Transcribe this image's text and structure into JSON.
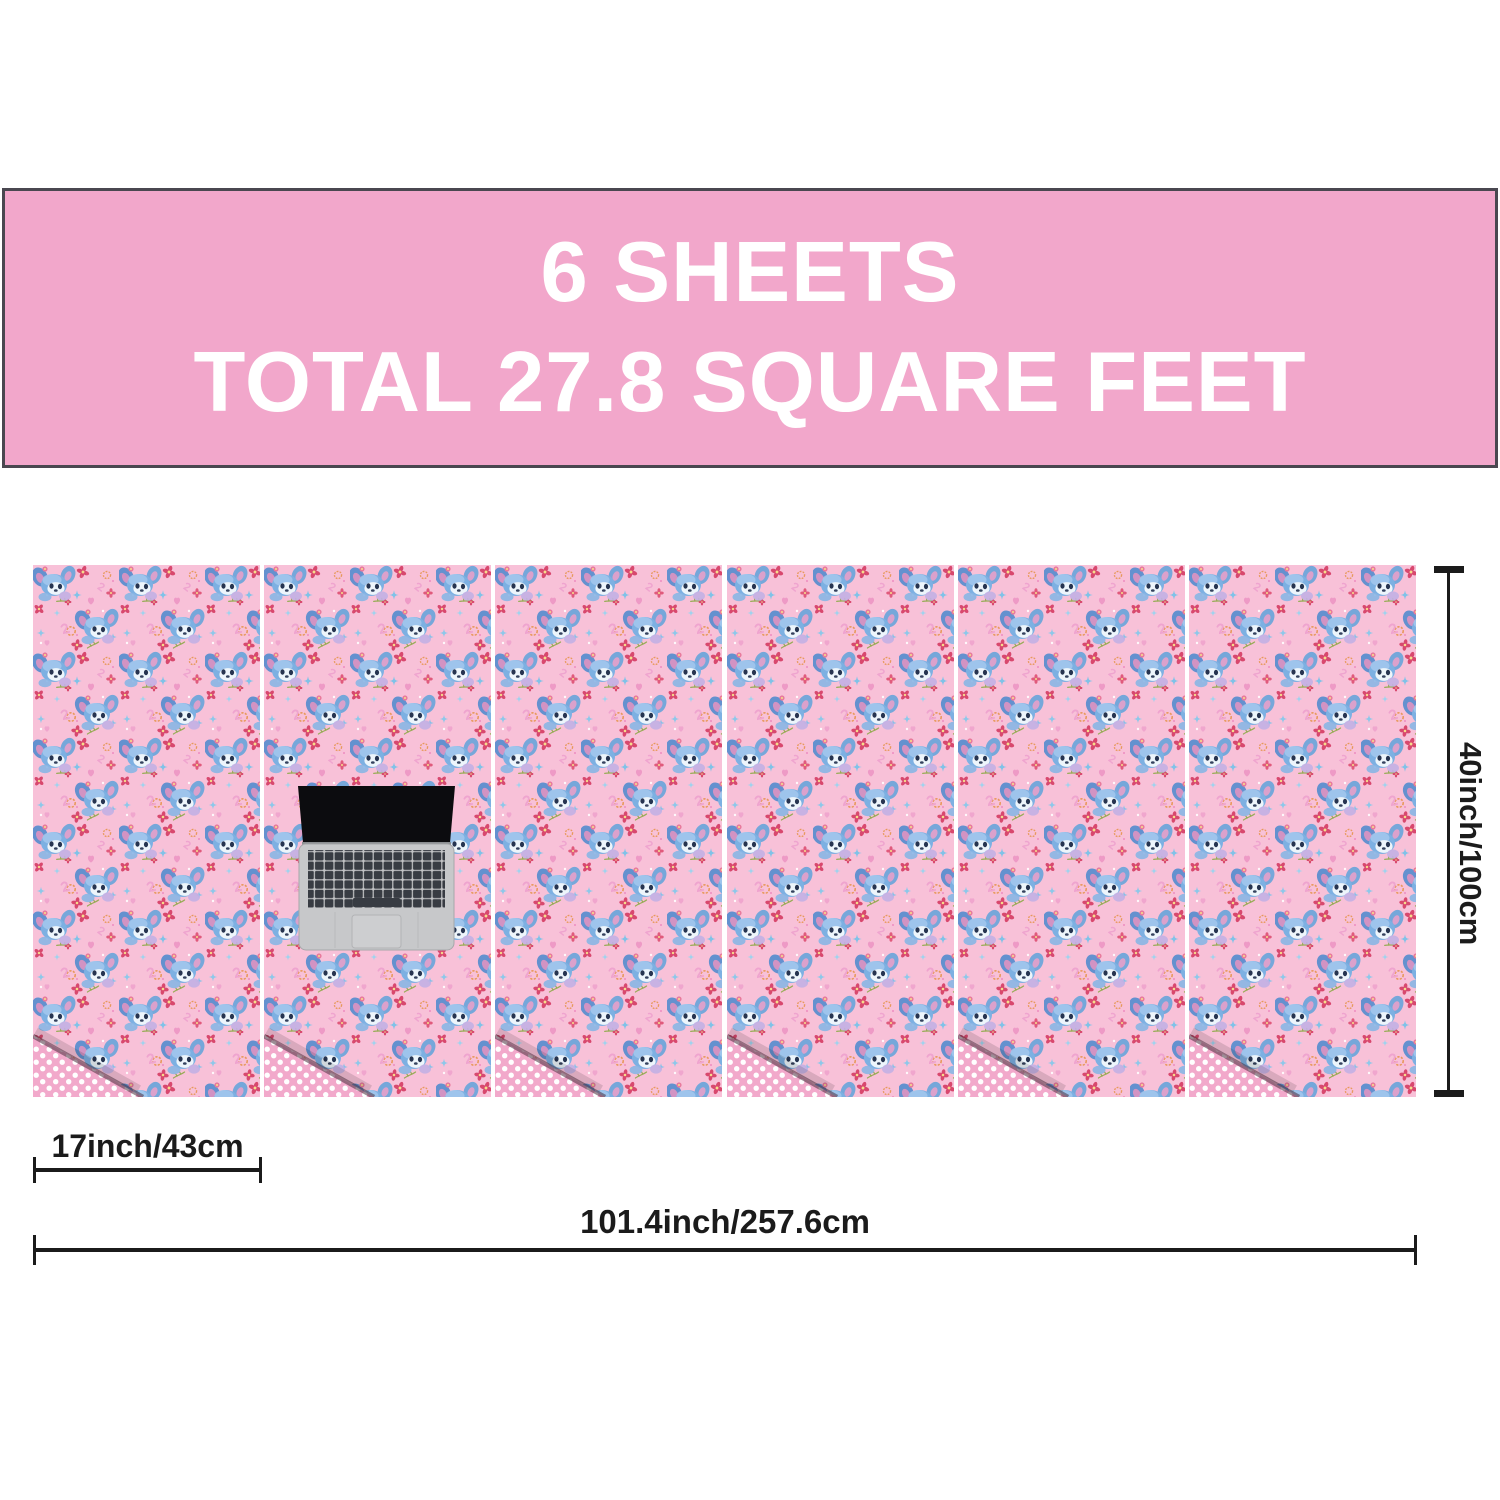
{
  "banner": {
    "line1": "6 SHEETS",
    "line2": "TOTAL 27.8 SQUARE FEET"
  },
  "sheets": {
    "count": 6,
    "pattern_description": "pink wrapping paper with blue cartoon koala characters, red flowers, blue crosses, orange rings and pink hearts",
    "fold_backside": "pink with white polka dots"
  },
  "dimensions": {
    "single_sheet_width": "17inch/43cm",
    "total_width": "101.4inch/257.6cm",
    "sheet_height": "40inch/100cm"
  },
  "icons": {
    "laptop": "laptop-top-view-scale-reference"
  },
  "colors": {
    "banner_background": "#f2a7cb",
    "banner_text": "#ffffff",
    "banner_border": "#4a4750",
    "paper_pink": "#f8c1d8",
    "polka_pink": "#f2a9cb",
    "dimension_line": "#1b1b1b"
  }
}
